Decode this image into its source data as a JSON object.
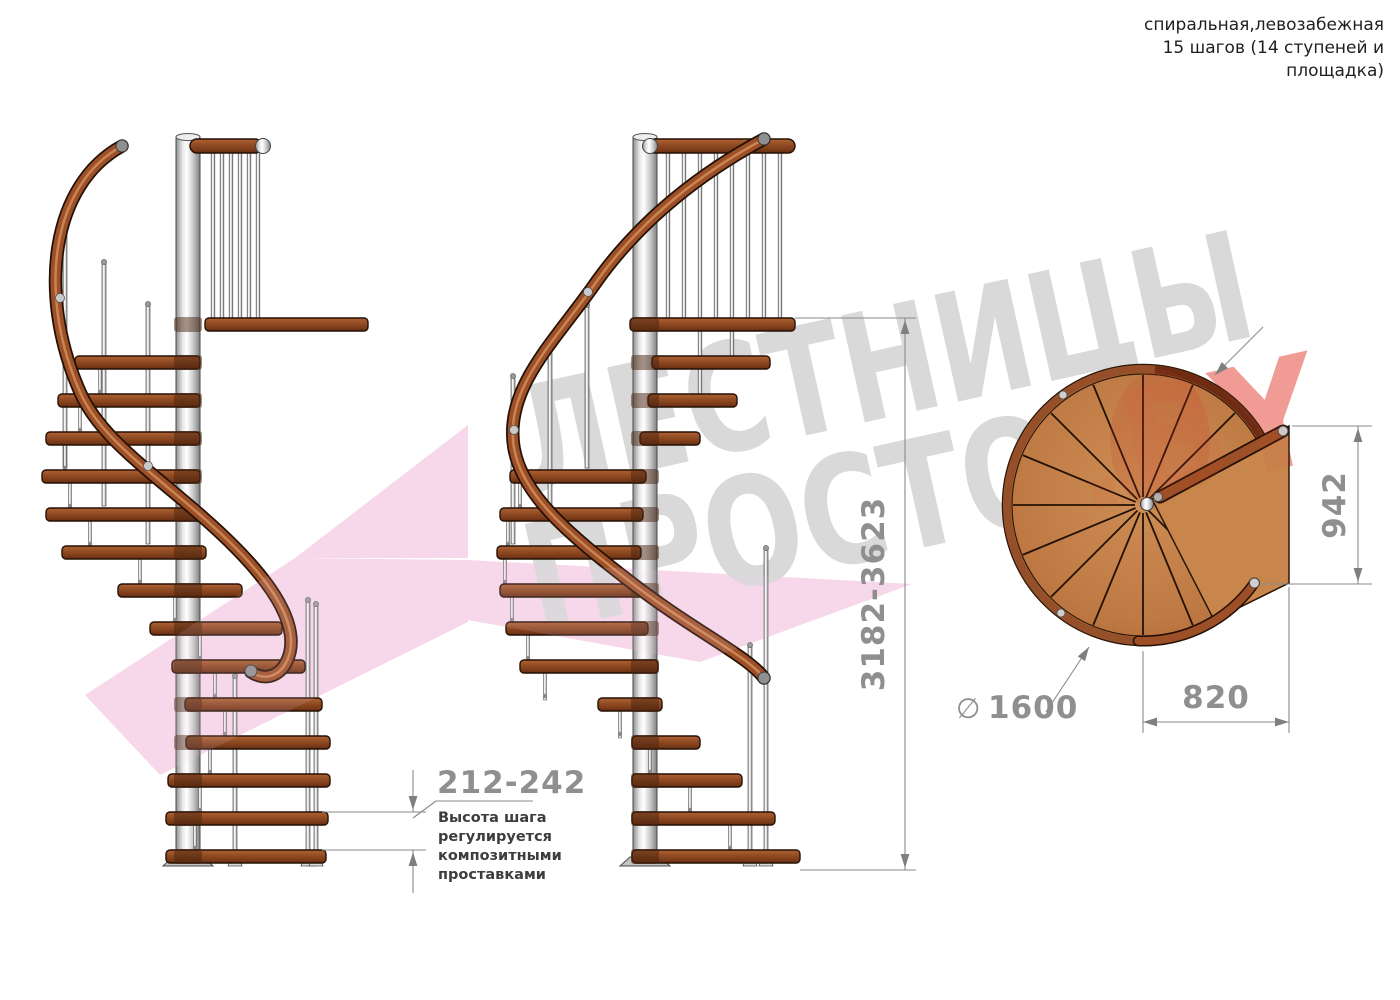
{
  "header": {
    "line1": "спиральная,левозабежная",
    "line2": "15 шагов (14 ступеней и",
    "line3": "площадка)"
  },
  "watermark": {
    "word_top": "ЛЕСТНИЦЫ",
    "word_bottom": "ПРОСТО",
    "suffix": ".BY"
  },
  "dimensions": {
    "step_height": {
      "value": "212-242",
      "note_lines": [
        "Высота шага",
        "регулируется",
        "композитными",
        "проставками"
      ]
    },
    "total_height": {
      "value": "3182-3623"
    },
    "landing_width": {
      "value": "942"
    },
    "landing_depth": {
      "value": "820"
    },
    "diameter": {
      "symbol": "∅",
      "value": "1600"
    }
  },
  "colors": {
    "header_text": "#1f1f1f",
    "dimension_text": "#8f8f8f",
    "note_text": "#3d3d3d",
    "line": "#8a8a8a",
    "watermark_gray": "#d9d9d9",
    "watermark_red": "#e6473d",
    "watermark_pink": "#f6d2e9",
    "wood": "#9d5027",
    "wood_dark": "#6d3414",
    "metal": "#d9d9d9"
  }
}
